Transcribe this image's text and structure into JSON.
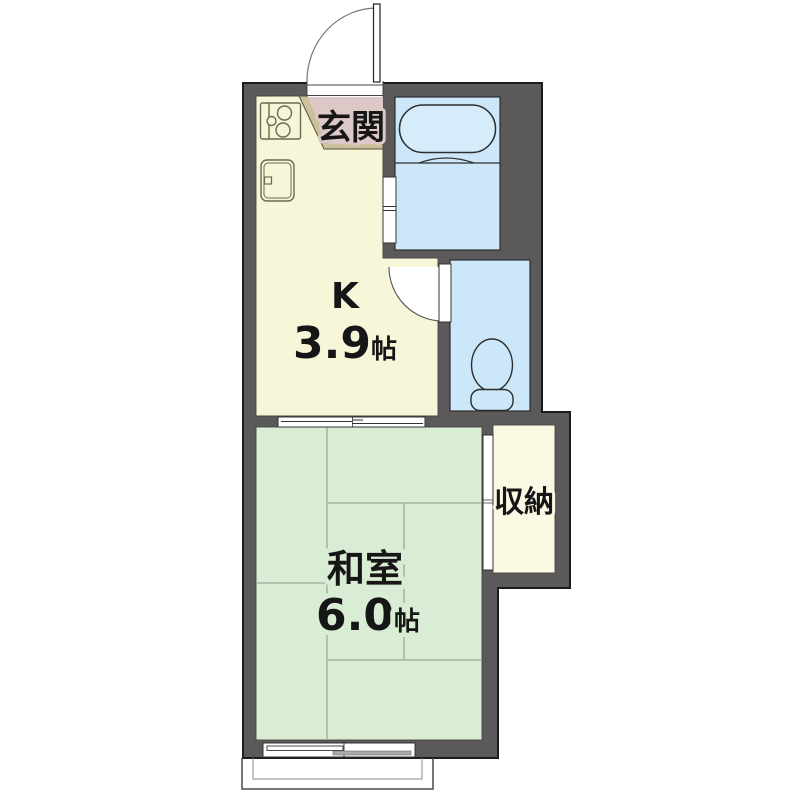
{
  "plan": {
    "type": "apartment-floor-plan",
    "palette": {
      "wall": "#5b5959",
      "outline": "#1c1c1c",
      "kitchen": "#f8f6d9",
      "entrance": "#dcc8c6",
      "entrance_step_edge": "#cbc19a",
      "water": "#cbe7f9",
      "bathtub": "#d6ecfb",
      "tatami_room": "#d9ecd4",
      "storage": "#fbf9e4",
      "tatami_line": "#98ab98"
    },
    "rooms": {
      "entrance": {
        "label": "玄関"
      },
      "kitchen": {
        "label": "K",
        "size": "3.9",
        "unit": "帖"
      },
      "japanese_room": {
        "label": "和室",
        "size": "6.0",
        "unit": "帖"
      },
      "storage": {
        "label": "収納"
      }
    },
    "icons": {
      "stove": "stove-burners-icon",
      "sink": "kitchen-sink-icon",
      "bathtub": "bathtub-icon",
      "toilet": "toilet-icon",
      "door_swings": "door-swing-arc",
      "sliding_doors": "sliding-door-symbol",
      "window": "sliding-window-symbol",
      "balcony": "balcony-outline"
    }
  }
}
